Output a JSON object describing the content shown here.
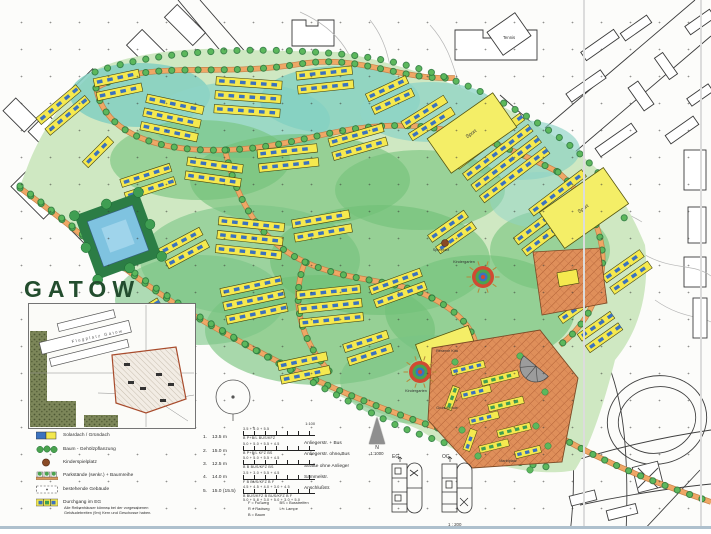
{
  "title": "GATOW",
  "inset": {
    "label": "Flugplatz Gatow"
  },
  "palette": {
    "paper": "#fcfcfa",
    "ink": "#2e2e2e",
    "title_green": "#234d2e",
    "site_green": "#cfe8c2",
    "teal": "#82cfc1",
    "leaf": "#6fbf77",
    "tree": "#3f9e52",
    "house_yellow": "#f5e94f",
    "roof_blue": "#3b72bf",
    "road_orange": "#efa765",
    "plaza_orange": "#df8f5a",
    "plaza_line": "#b05f33",
    "accent_red": "#cc4432",
    "pond_blue": "#7fc3e0",
    "grey": "#9a9a9a",
    "fold": "#dcdcdc",
    "bottom_edge": "#aec0cd"
  },
  "map_labels": [
    {
      "text": "Tennis",
      "x": 509,
      "y": 39,
      "s": 4.2,
      "rot": 0
    },
    {
      "text": "Sport",
      "x": 472,
      "y": 135,
      "s": 5,
      "rot": -35
    },
    {
      "text": "Sport",
      "x": 584,
      "y": 210,
      "s": 5,
      "rot": -35
    },
    {
      "text": "Spielplatz",
      "x": 441,
      "y": 251,
      "s": 3.8,
      "rot": 0
    },
    {
      "text": "Kindergarten",
      "x": 464,
      "y": 263,
      "s": 3.8,
      "rot": 0
    },
    {
      "text": "Reserve Kita",
      "x": 447,
      "y": 352,
      "s": 3.8,
      "rot": 0
    },
    {
      "text": "Kindergarten",
      "x": 416,
      "y": 392,
      "s": 3.8,
      "rot": 0
    },
    {
      "text": "Grundschule",
      "x": 447,
      "y": 409,
      "s": 3.8,
      "rot": 0
    },
    {
      "text": "Marktplatz",
      "x": 508,
      "y": 462,
      "s": 3.8,
      "rot": 0
    }
  ],
  "legend": {
    "items": [
      {
        "swatch": "solar",
        "label": "Solardach / Gründach"
      },
      {
        "swatch": "trees",
        "label": "Baum - Gehölzpflanzung"
      },
      {
        "swatch": "playground",
        "label": "Kinderspielplatz"
      },
      {
        "swatch": "parking",
        "label": "Parkstände (senkr.) + Baumreihe"
      },
      {
        "swatch": "existing",
        "label": "bestehende Gebäude"
      },
      {
        "swatch": "passage",
        "label": "Durchgang im EG"
      }
    ],
    "note": "Alle Reihenhäuser können bei der vorgesehenen Gebäudebreiten (9m) Kern und Geschosse haben."
  },
  "dimensions": [
    {
      "n": "1.",
      "v": "13.5 m"
    },
    {
      "n": "2.",
      "v": "15.0 m"
    },
    {
      "n": "3.",
      "v": "12.5 m"
    },
    {
      "n": "4.",
      "v": "14.0 m"
    },
    {
      "n": "5.",
      "v": "15.0 (15.5)"
    }
  ],
  "sections": {
    "scale": "1:100",
    "rows": [
      {
        "widths": "3.5 + 5.0 + 5.5",
        "lanes": "B   P+B/L   BUS/KFZ"
      },
      {
        "widths": "5.0 + 5.0 + 5.5 + 4.5",
        "lanes": "B   P+B/L   KFZ   BS"
      },
      {
        "widths": "5.0 + 5.0 + 5.5 + 4.5",
        "lanes": "B   B   BUS/KFZ   BS"
      },
      {
        "widths": "3.5 + 3.0 + 5.5 + 4.5",
        "lanes": "F   B   BUS/KFZ   B   F"
      },
      {
        "widths": "4.5 + 4.5 + 4.0 + 3.0 + 4.5",
        "lanes": "B   BUS/KFZ   B   BUS/KFZ   B   F",
        "widths2": "5.0 + 5.8 + 3.0 + 5.0 + 3.0 + 5.0"
      }
    ],
    "abbrev_col1": [
      "F = Fußweg",
      "R = Radweg",
      "B = Baum"
    ],
    "abbrev_col2": [
      "BS = Busstreifen",
      "L = Lampe"
    ]
  },
  "street_types": [
    "Anliegerstr. + Bus",
    "Anliegerstr. ohne Bus",
    "Straße ohne Anlieger",
    "Sammelstr.",
    "Anschlußstr."
  ],
  "north": {
    "label": "N",
    "scale": "1:1000"
  },
  "plans": {
    "left_label": "EG",
    "right_label": "OG",
    "scale": "1 : 200"
  }
}
